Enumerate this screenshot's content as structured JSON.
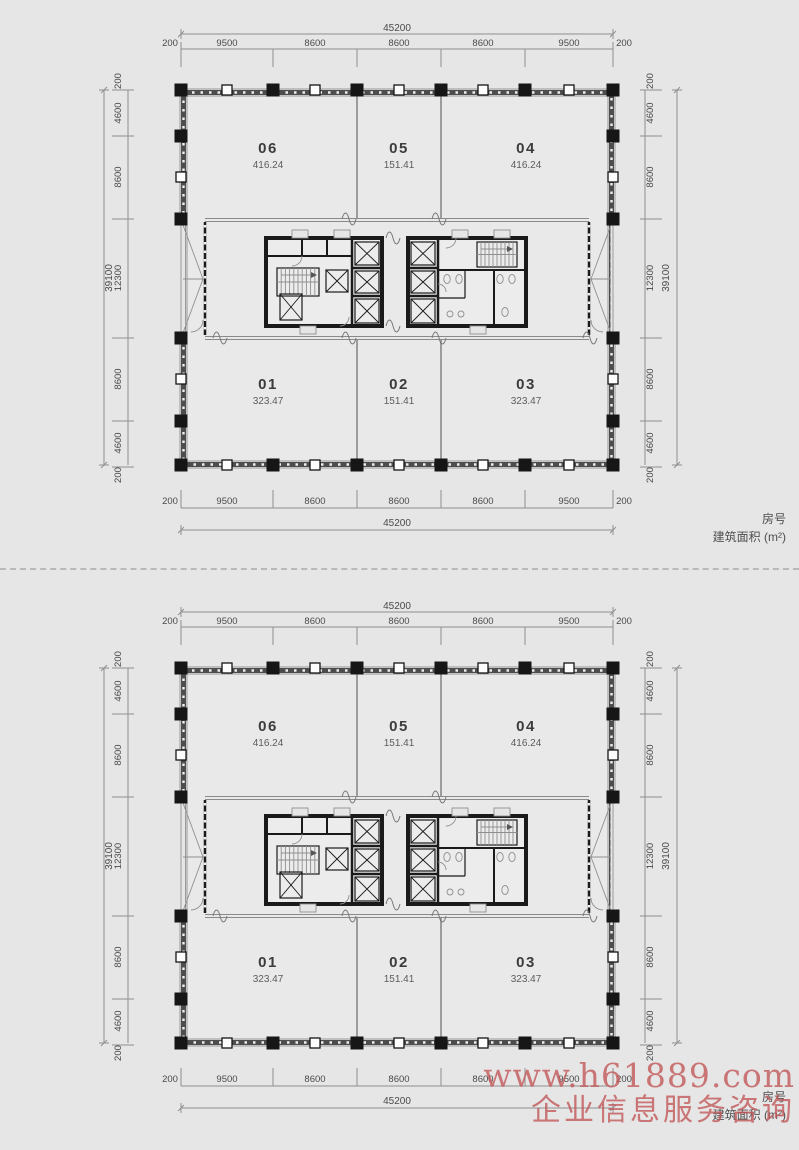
{
  "page": {
    "background": "#e6e6e6"
  },
  "legend": {
    "line1": "房号",
    "line2": "建筑面积 (m²)"
  },
  "watermark": {
    "line1": "www.h61889.com",
    "line2": "企业信息服务咨询",
    "color": "#c3585a"
  },
  "plans": [
    {
      "name": "floor-plan-upper",
      "rooms": [
        {
          "id": "06",
          "area": "416.24",
          "row": "top",
          "col": 0
        },
        {
          "id": "05",
          "area": "151.41",
          "row": "top",
          "col": 1
        },
        {
          "id": "04",
          "area": "416.24",
          "row": "top",
          "col": 2
        },
        {
          "id": "01",
          "area": "323.47",
          "row": "bottom",
          "col": 0
        },
        {
          "id": "02",
          "area": "151.41",
          "row": "bottom",
          "col": 1
        },
        {
          "id": "03",
          "area": "323.47",
          "row": "bottom",
          "col": 2
        }
      ],
      "dimensions": {
        "horizontal_total": "45200",
        "horizontal_chain": [
          "200",
          "9500",
          "8600",
          "8600",
          "8600",
          "9500",
          "200"
        ],
        "vertical_total": "39100",
        "vertical_chain": [
          "200",
          "4600",
          "8600",
          "12300",
          "8600",
          "4600",
          "200"
        ]
      }
    },
    {
      "name": "floor-plan-lower",
      "rooms": [
        {
          "id": "06",
          "area": "416.24",
          "row": "top",
          "col": 0
        },
        {
          "id": "05",
          "area": "151.41",
          "row": "top",
          "col": 1
        },
        {
          "id": "04",
          "area": "416.24",
          "row": "top",
          "col": 2
        },
        {
          "id": "01",
          "area": "323.47",
          "row": "bottom",
          "col": 0
        },
        {
          "id": "02",
          "area": "151.41",
          "row": "bottom",
          "col": 1
        },
        {
          "id": "03",
          "area": "323.47",
          "row": "bottom",
          "col": 2
        }
      ],
      "dimensions": {
        "horizontal_total": "45200",
        "horizontal_chain": [
          "200",
          "9500",
          "8600",
          "8600",
          "8600",
          "9500",
          "200"
        ],
        "vertical_total": "39100",
        "vertical_chain": [
          "200",
          "4600",
          "8600",
          "12300",
          "8600",
          "4600",
          "200"
        ]
      }
    }
  ]
}
